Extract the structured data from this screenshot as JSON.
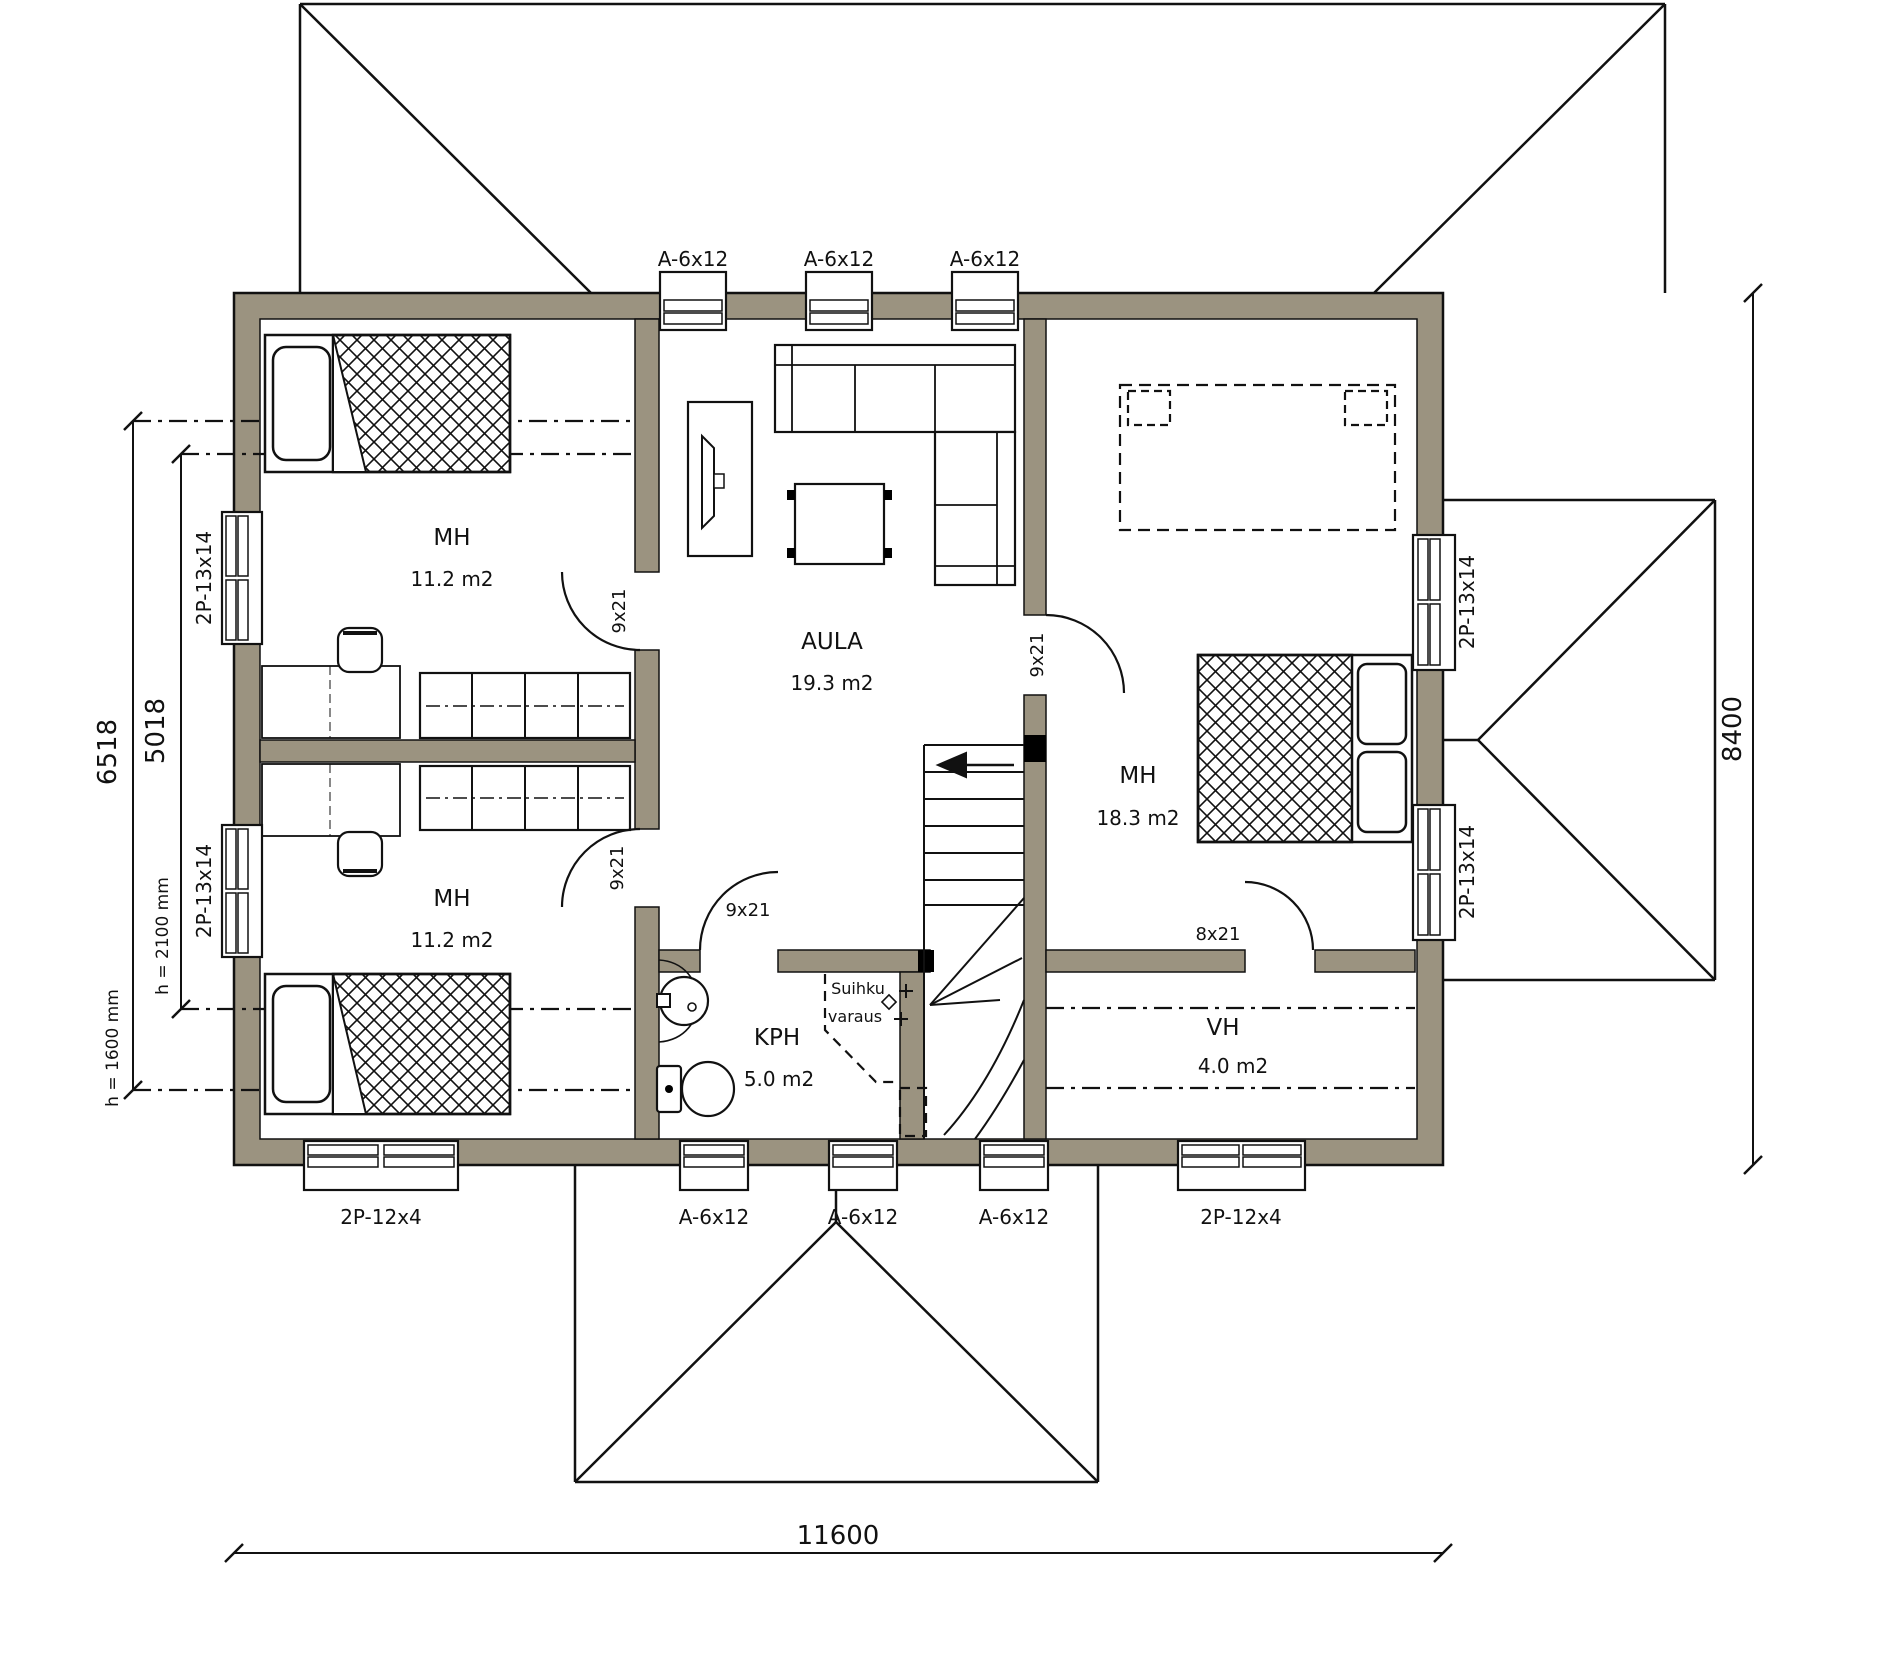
{
  "rooms": {
    "mh_upper_left": {
      "name": "MH",
      "area": "11.2 m2"
    },
    "mh_lower_left": {
      "name": "MH",
      "area": "11.2 m2"
    },
    "aula": {
      "name": "AULA",
      "area": "19.3 m2"
    },
    "mh_right": {
      "name": "MH",
      "area": "18.3 m2"
    },
    "kph": {
      "name": "KPH",
      "area": "5.0 m2"
    },
    "vh": {
      "name": "VH",
      "area": "4.0 m2"
    }
  },
  "windows": {
    "top": [
      "A-6x12",
      "A-6x12",
      "A-6x12"
    ],
    "bottom": [
      "2P-12x4",
      "A-6x12",
      "A-6x12",
      "A-6x12",
      "2P-12x4"
    ],
    "left": [
      "2P-13x14",
      "2P-13x14"
    ],
    "right": [
      "2P-13x14",
      "2P-13x14"
    ]
  },
  "doors": {
    "upper_left": "9x21",
    "lower_left": "9x21",
    "right": "9x21",
    "kph": "9x21",
    "vh": "8x21"
  },
  "dimensions": {
    "total_width": "11600",
    "total_depth": "8400",
    "left_outer": "6518",
    "left_inner": "5018",
    "height_outer": "h = 1600 mm",
    "height_inner": "h = 2100 mm"
  },
  "annotations": {
    "shower_line1": "Suihku",
    "shower_line2": "varaus"
  },
  "colors": {
    "wall_fill": "#9b9380",
    "line": "#000000",
    "background": "#ffffff"
  }
}
